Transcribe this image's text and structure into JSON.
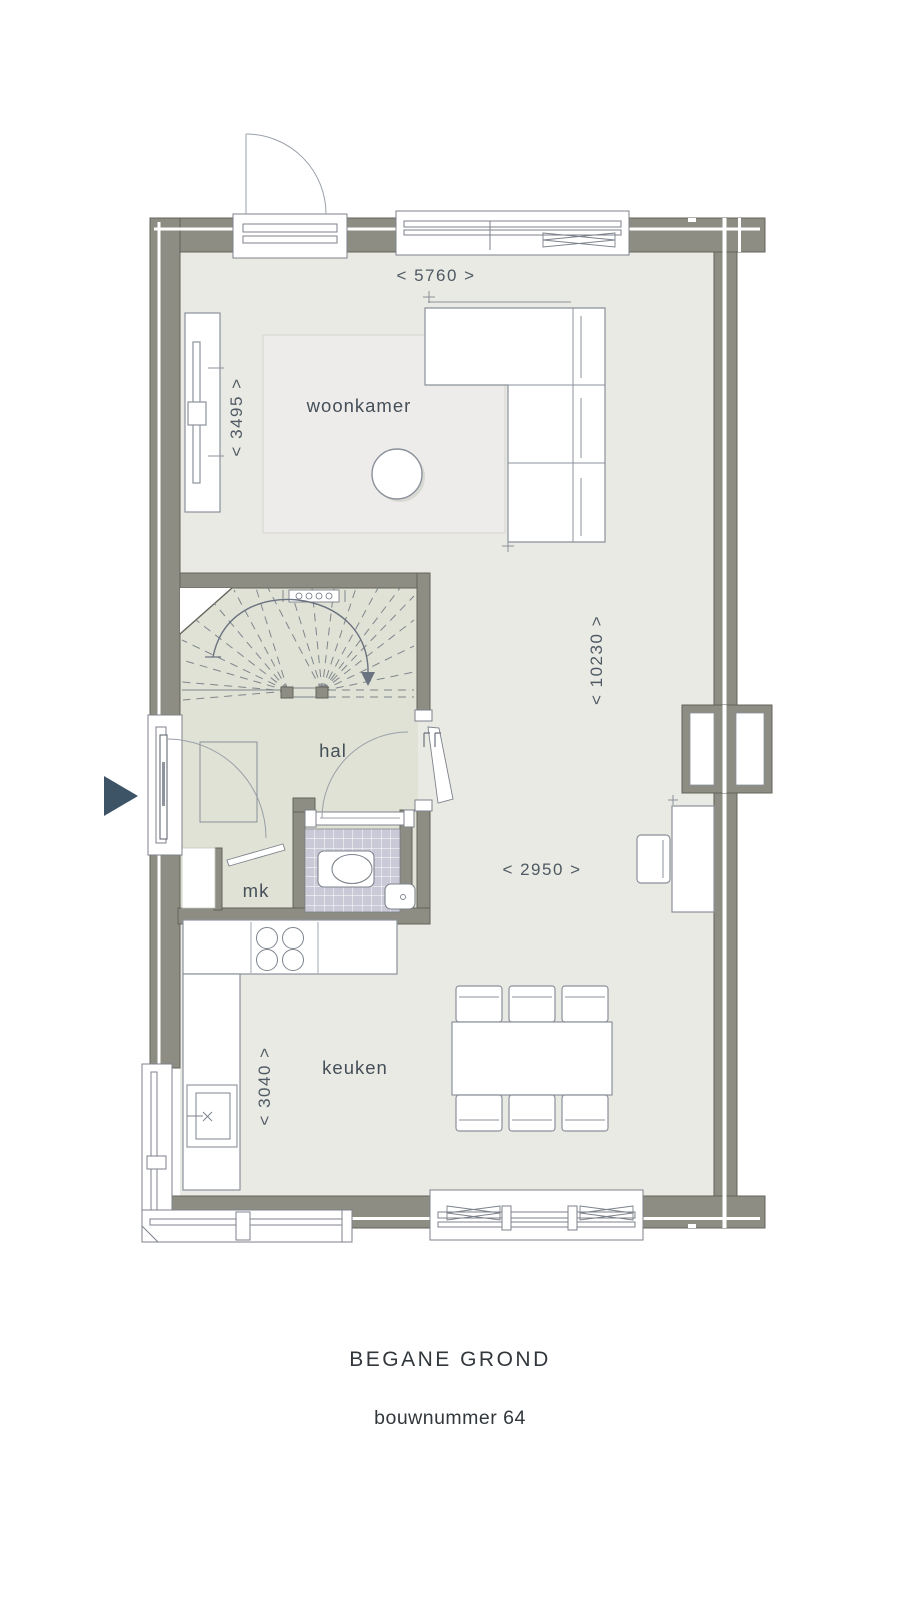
{
  "titles": {
    "floor_name": "BEGANE GROND",
    "build_number": "bouwnummer 64"
  },
  "rooms": {
    "living": "woonkamer",
    "hall": "hal",
    "kitchen": "keuken",
    "meter_cupboard": "mk"
  },
  "dimensions": {
    "top_width": "< 5760 >",
    "living_width": "< 3495 >",
    "total_depth": "< 10230 >",
    "kitchen_width": "< 2950 >",
    "kitchen_depth": "< 3040 >"
  },
  "icons": {
    "entrance_arrow": "entrance-direction-arrow"
  },
  "colors": {
    "wall": "#8d8d83",
    "floor": "#e9eae3",
    "hall_floor": "#dfe2d4",
    "toilet_tile": "#cac9d7",
    "rug": "#edecea",
    "accent_arrow": "#3d5366",
    "line_work": "#8b919b",
    "label_text": "#454f59",
    "dimension_text": "#4e5963",
    "title_text": "#32373c"
  }
}
